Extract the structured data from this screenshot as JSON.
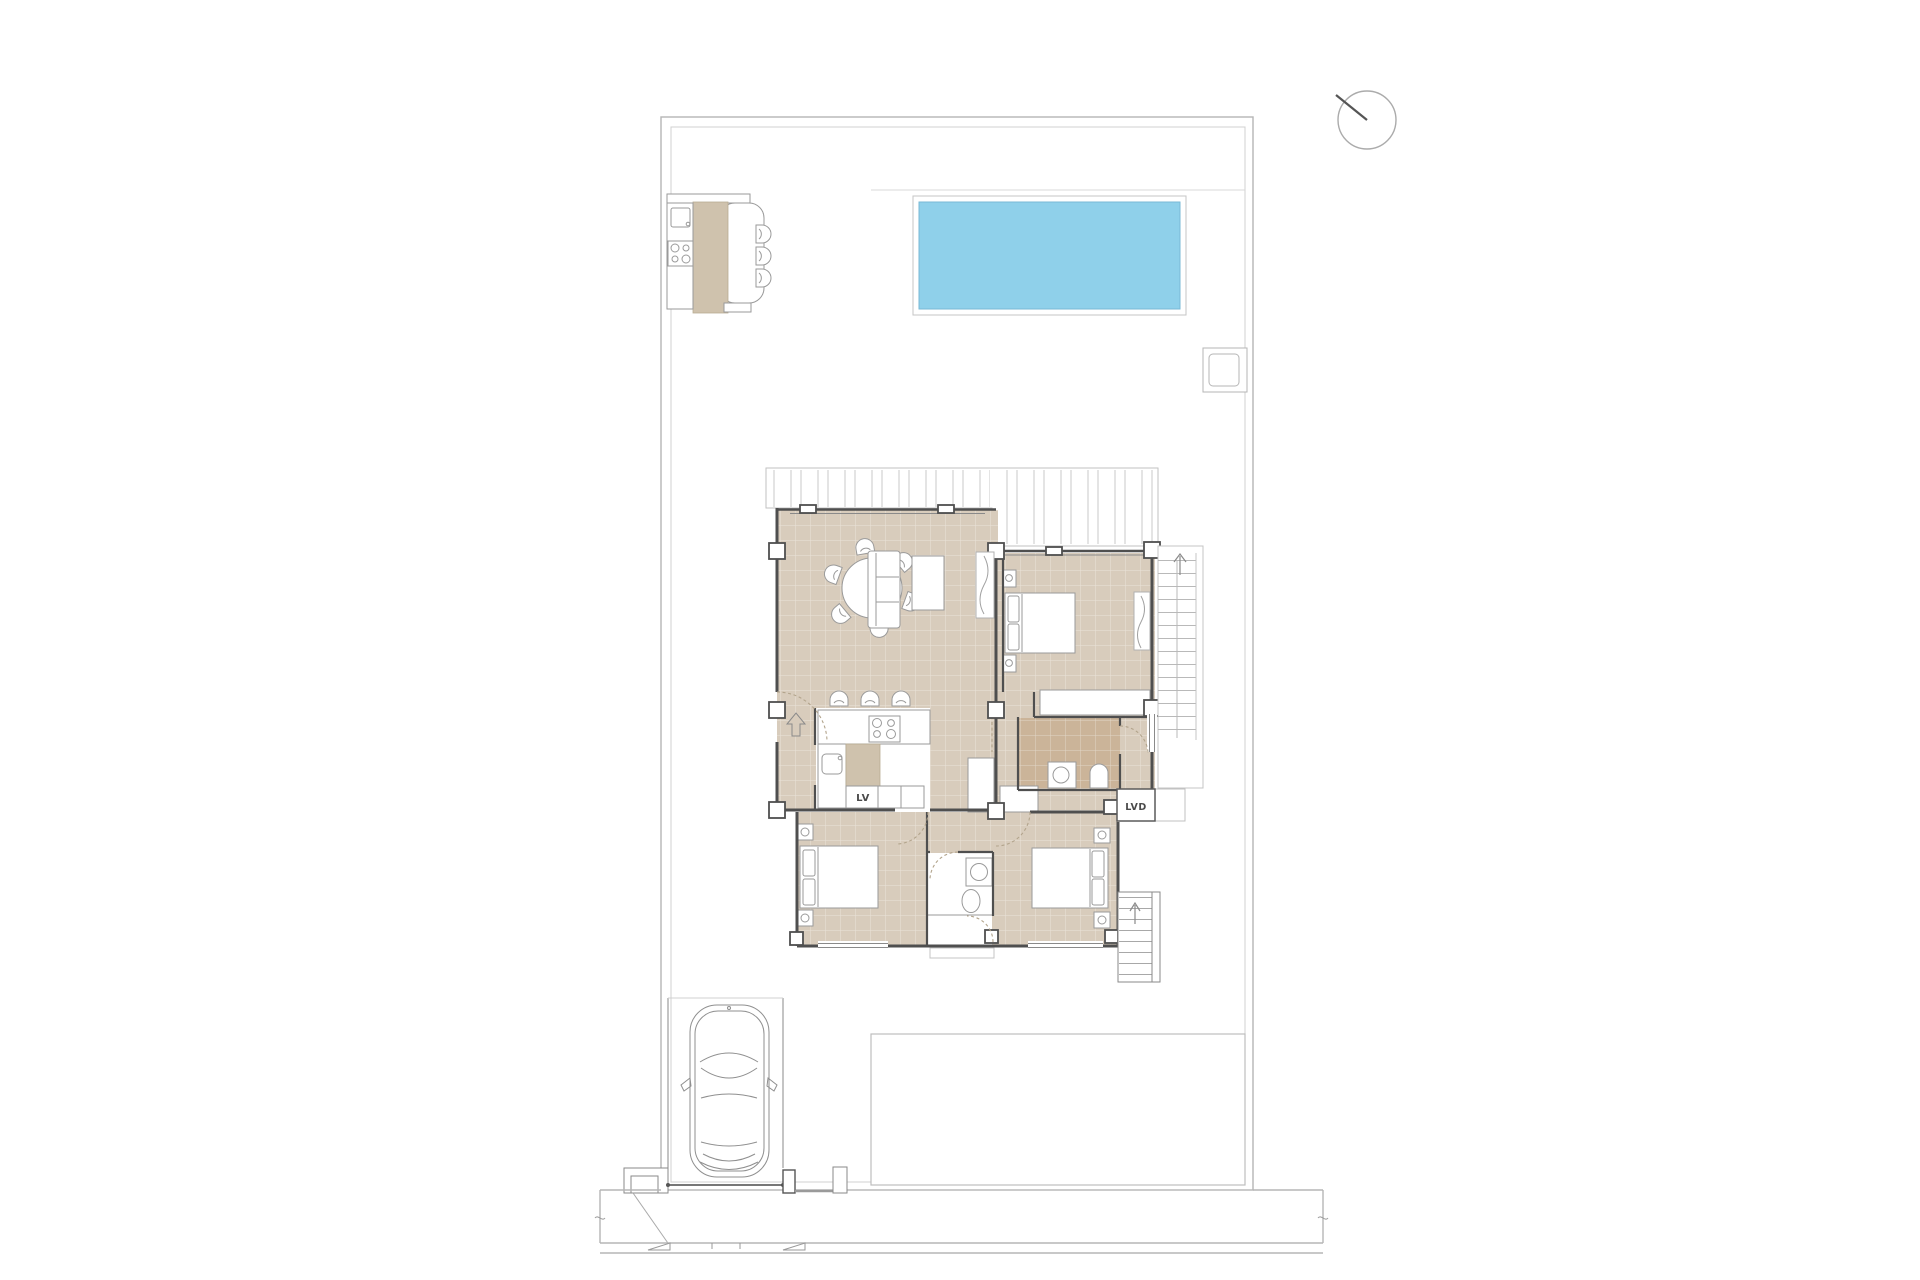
{
  "labels": {
    "dishwasher": "LV",
    "laundry": "LVD"
  },
  "colors": {
    "pool_water": "#8fd0ea",
    "floor_main": "#d8ccbc",
    "floor_bath": "#cbb499",
    "counter_top": "#cfc2ad",
    "wall": "#4f4f4f",
    "furniture_outline": "#9a9a9a",
    "site_line": "#b5b5b5"
  },
  "diagram": {
    "type": "architectural-floor-plan",
    "features": [
      "plot-boundary",
      "north-indicator",
      "outdoor-kitchen",
      "swimming-pool",
      "pool-equipment-box",
      "pergola",
      "living-dining-room",
      "kitchen",
      "bedroom",
      "bathroom",
      "ensuite-bathroom",
      "wardrobe",
      "staircase",
      "exterior-staircase",
      "laundry-unit",
      "patio",
      "carport",
      "car",
      "driveway-gate",
      "sidewalk"
    ]
  }
}
